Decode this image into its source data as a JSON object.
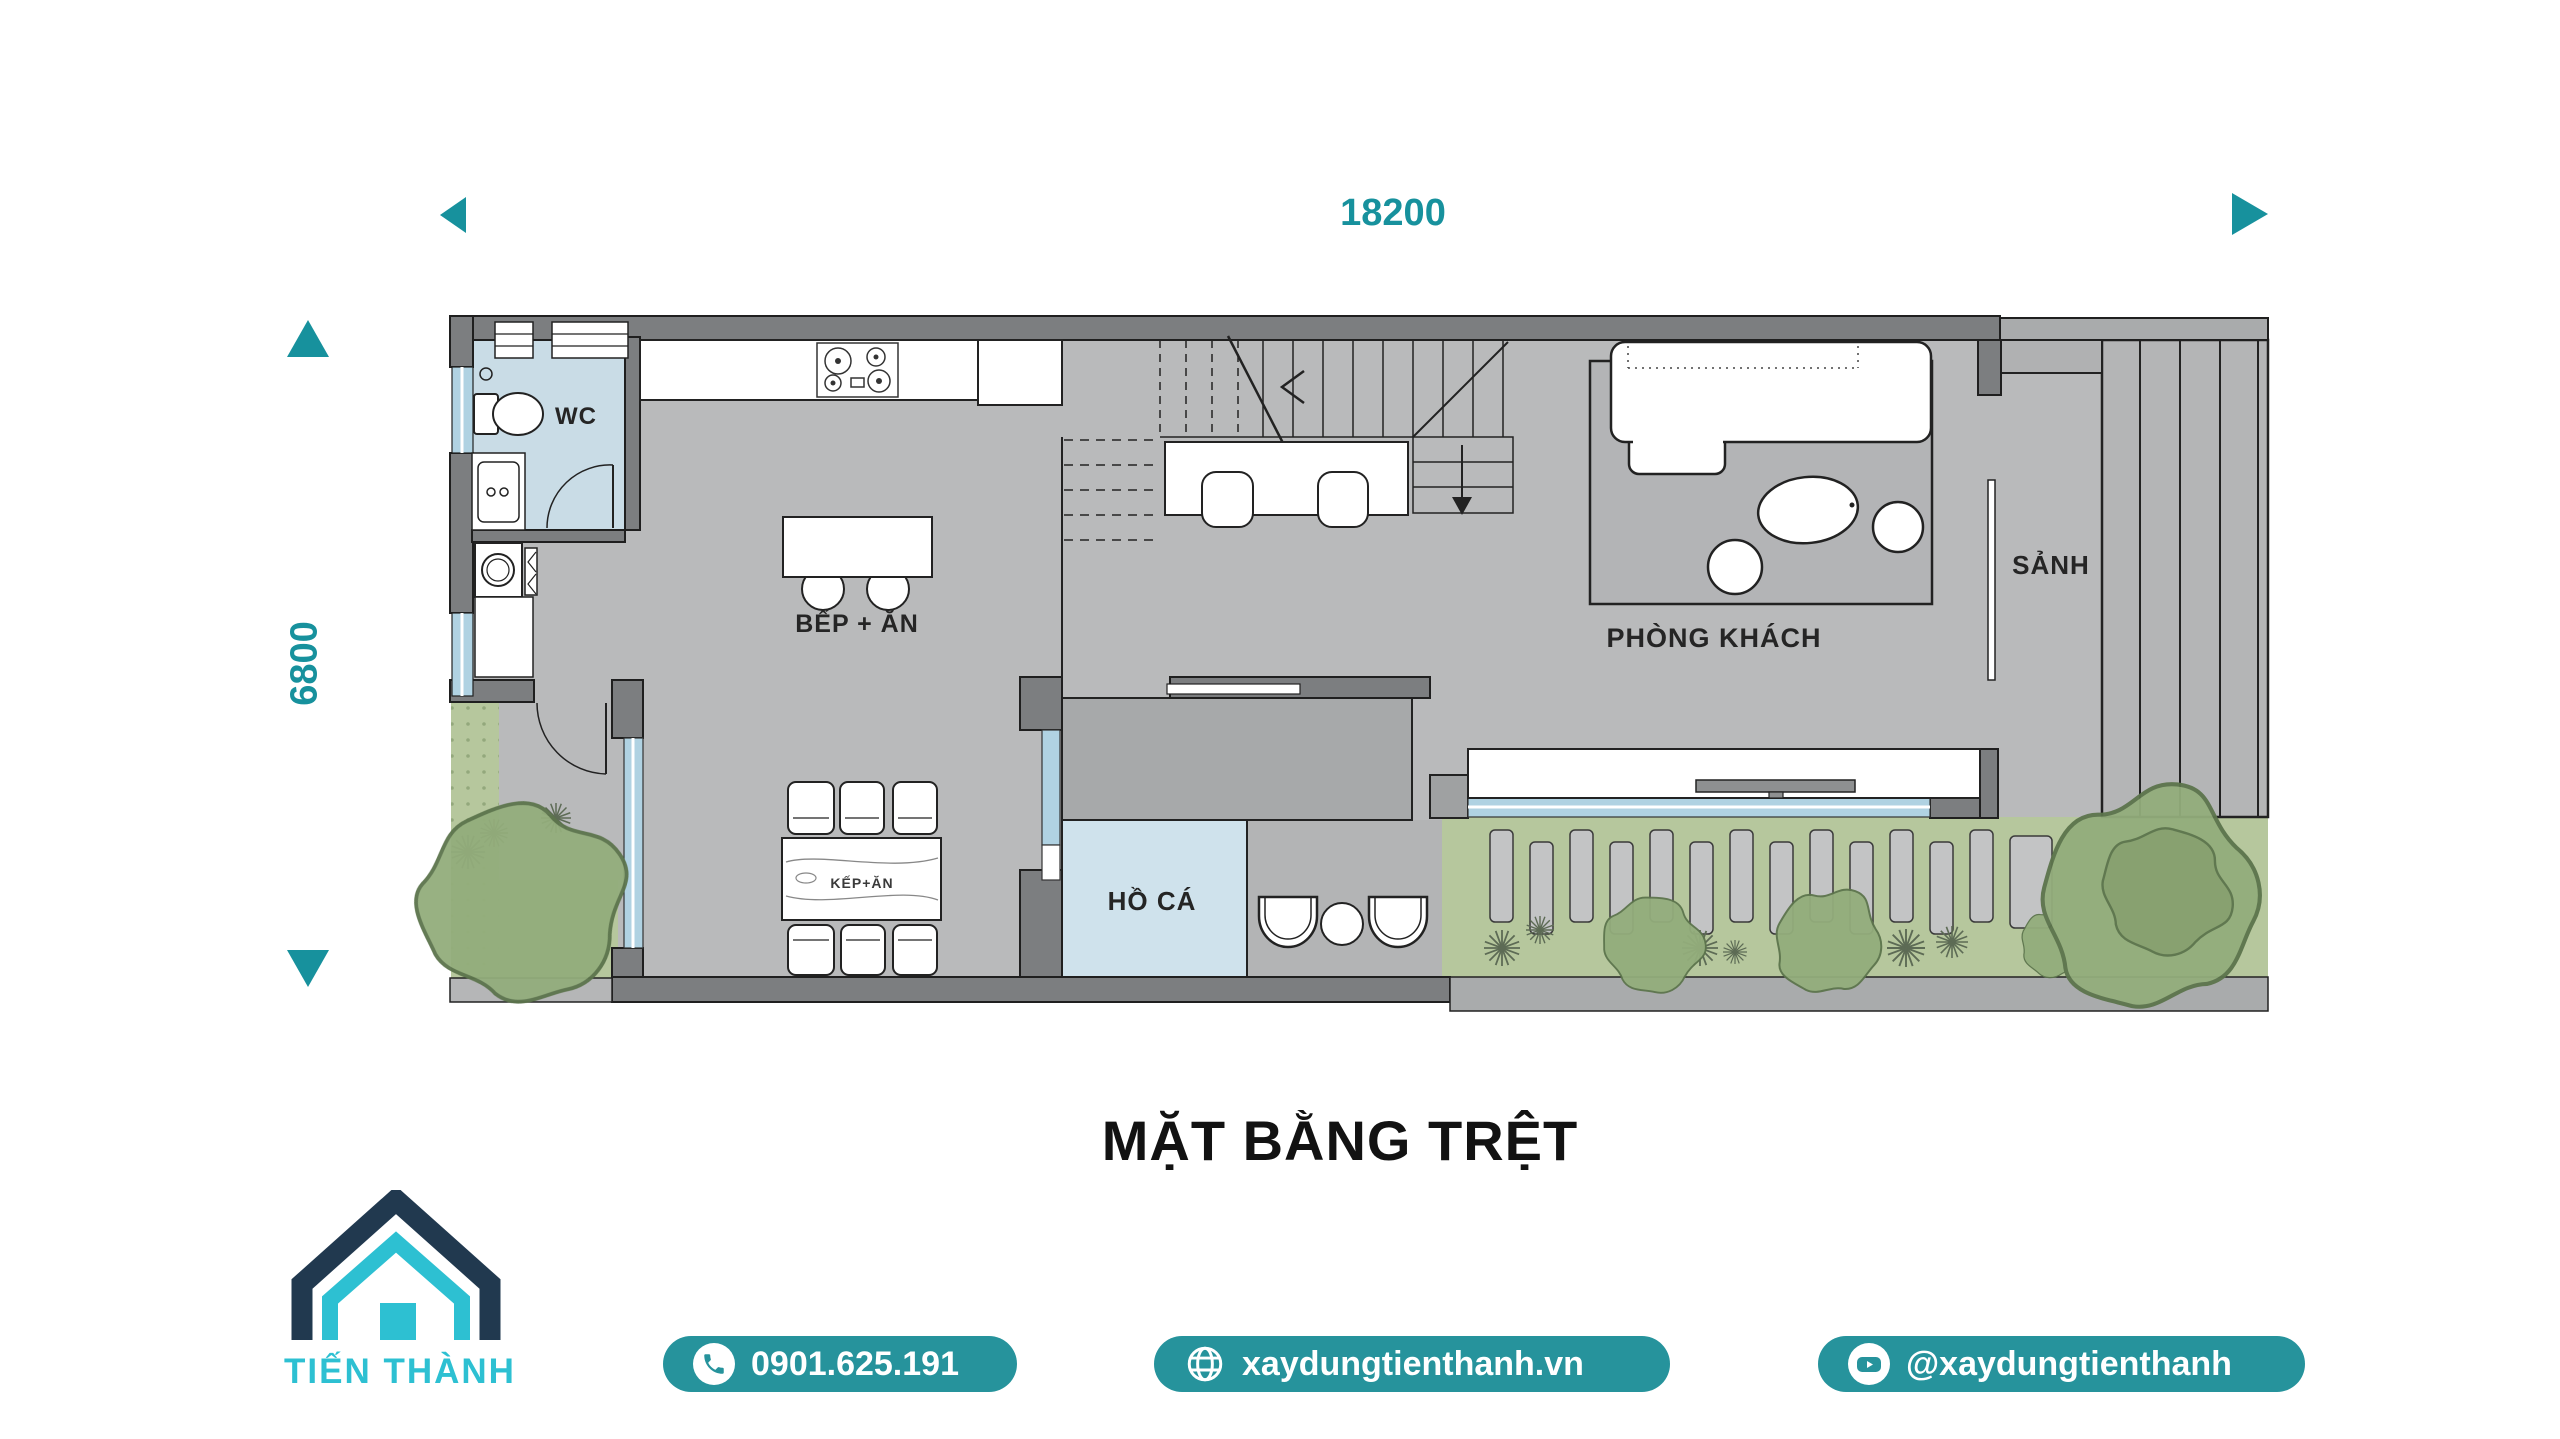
{
  "dimension_top": {
    "label": "18200"
  },
  "dimension_left": {
    "label": "6800"
  },
  "plan": {
    "rooms": {
      "wc": "WC",
      "kitchen_dining": "BẾP + ĂN",
      "living_room": "PHÒNG KHÁCH",
      "hall": "SẢNH",
      "fish_pond": "HỒ CÁ"
    },
    "dining_table_label": "KẾP+ĂN"
  },
  "title": "MẶT BẰNG TRỆT",
  "footer": {
    "brand": "TIẾN THÀNH",
    "phone": "0901.625.191",
    "website": "xaydungtienthanh.vn",
    "social_handle": "@xaydungtienthanh"
  },
  "colors": {
    "teal_accent": "#17919d",
    "button_teal": "#26939c",
    "logo_navy": "#21394f",
    "logo_cyan": "#2dc0d2"
  }
}
